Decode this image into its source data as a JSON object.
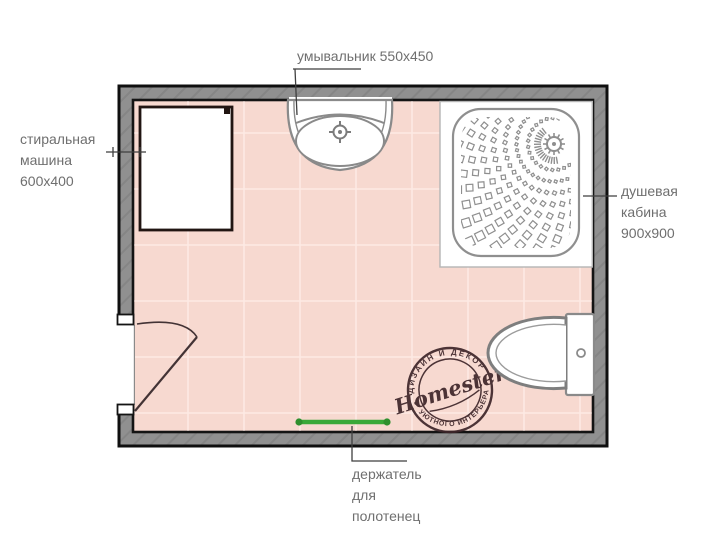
{
  "plan": {
    "labels": {
      "washbasin": {
        "text": "умывальник 550x450"
      },
      "washing_machine": {
        "line1": "стиральная",
        "line2": "машина",
        "line3": "600x400"
      },
      "shower": {
        "line1": "душевая",
        "line2": "кабина",
        "line3": "900x900"
      },
      "towel_holder": {
        "line1": "держатель",
        "line2": "для",
        "line3": "полотенец"
      }
    },
    "logo": {
      "name": "Homester",
      "top_arc": "ДИЗАЙН И ДЕКОР",
      "bottom_arc": "УЮТНОГО ИНТЕРЬЕРА"
    },
    "colors": {
      "wall_fill": "#909090",
      "wall_outline": "#0f0f0f",
      "floor_fill": "#f7d9d0",
      "tile_grid": "#fdeae4",
      "fixture_stroke": "#8a8a8a",
      "machine_outline": "#211512",
      "door_stroke": "#433335",
      "towel_bar": "#3aa838",
      "towel_bar_ends": "#2f8f2e",
      "leader_line": "#3f3f3f",
      "label_text": "#6f6f6f",
      "logo_ink": "#3e262a"
    }
  }
}
